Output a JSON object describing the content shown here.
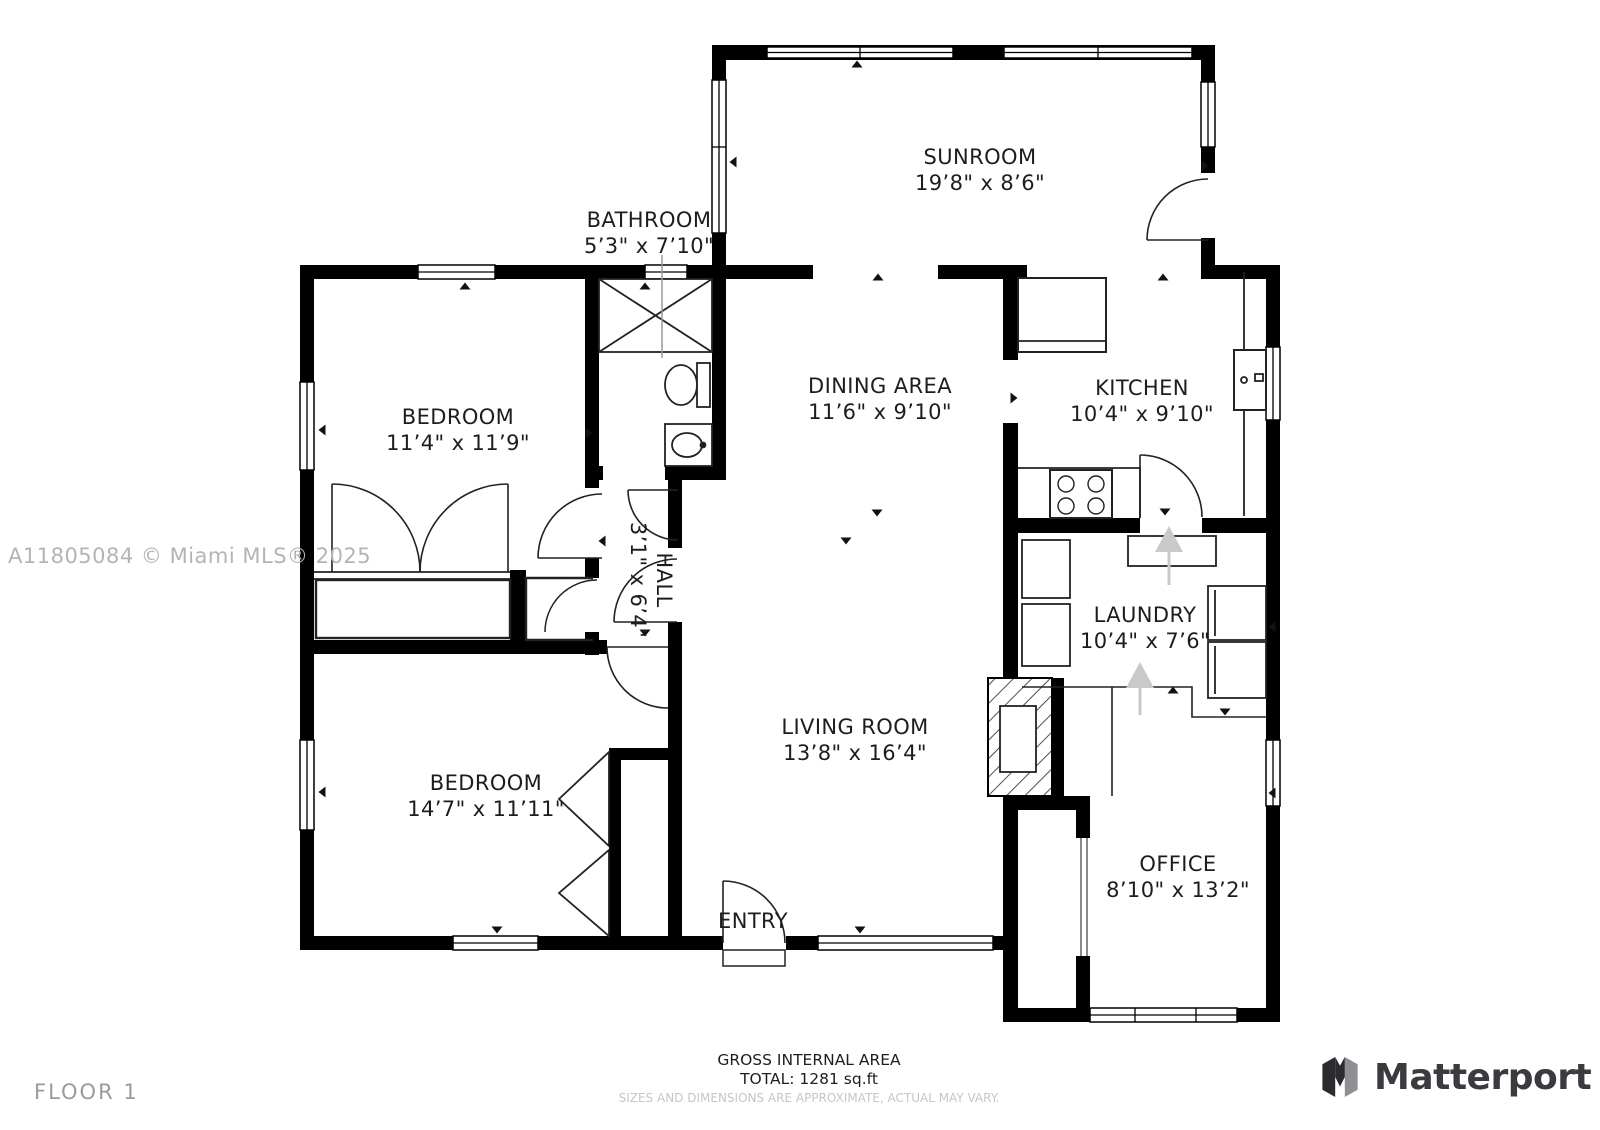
{
  "floor_plan": {
    "rooms": [
      {
        "id": "sunroom",
        "name": "SUNROOM",
        "dims": "19’8\" x 8’6\""
      },
      {
        "id": "bathroom",
        "name": "BATHROOM",
        "dims": "5’3\" x 7’10\""
      },
      {
        "id": "bedroom-1",
        "name": "BEDROOM",
        "dims": "11’4\" x 11’9\""
      },
      {
        "id": "dining-area",
        "name": "DINING AREA",
        "dims": "11’6\" x 9’10\""
      },
      {
        "id": "kitchen",
        "name": "KITCHEN",
        "dims": "10’4\" x 9’10\""
      },
      {
        "id": "hall",
        "name": "HALL",
        "dims": "3’1\" x 6’4\""
      },
      {
        "id": "laundry",
        "name": "LAUNDRY",
        "dims": "10’4\" x 7’6\""
      },
      {
        "id": "bedroom-2",
        "name": "BEDROOM",
        "dims": "14’7\" x 11’11\""
      },
      {
        "id": "living-room",
        "name": "LIVING ROOM",
        "dims": "13’8\" x 16’4\""
      },
      {
        "id": "office",
        "name": "OFFICE",
        "dims": "8’10\" x 13’2\""
      }
    ],
    "entry_label": "ENTRY",
    "footer": {
      "area_title": "GROSS INTERNAL AREA",
      "area_total": "TOTAL: 1281 sq.ft",
      "disclaimer": "SIZES AND DIMENSIONS ARE APPROXIMATE, ACTUAL MAY VARY."
    },
    "floor_label": "FLOOR 1",
    "watermark": "A11805084 © Miami MLS® 2025",
    "brand": {
      "name": "Matterport"
    },
    "colors": {
      "wall": "#000000",
      "label_text": "#1d1d1d",
      "muted_text": "#9b9b9b",
      "watermark_text": "#b4b4b4",
      "disclaimer_text": "#c6c6c6",
      "brand_text": "#3a3a3f",
      "entry_arrow": "#c9c9c9"
    }
  }
}
